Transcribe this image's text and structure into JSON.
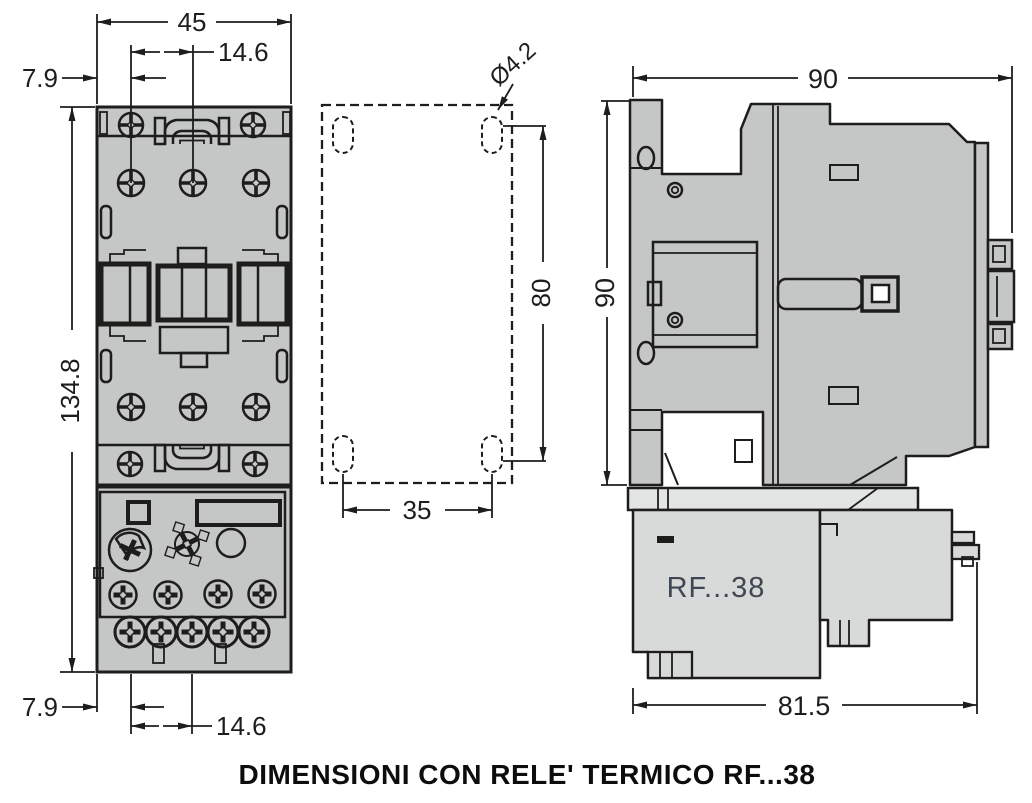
{
  "colors": {
    "line": "#1d1d1b",
    "contactor_fill": "#c5c6c6",
    "relay_fill": "#d8d9d9",
    "relay_strip_fill": "#e3e4e4",
    "relay_label_text": "#3e4752",
    "dim_text": "#1d1d1b",
    "background": "#ffffff"
  },
  "caption": "DIMENSIONI CON RELE' TERMICO RF...38",
  "front_view": {
    "dims": {
      "top_width": "45",
      "top_hole_spacing": "14.6",
      "top_edge_offset": "7.9",
      "total_height": "134.8",
      "bottom_edge_offset": "7.9",
      "bottom_hole_spacing": "14.6"
    }
  },
  "mounting_plan": {
    "dims": {
      "hole_diameter": "Ø4.2",
      "vertical_hole_spacing": "80",
      "horizontal_hole_spacing": "35"
    }
  },
  "side_view": {
    "dims": {
      "width": "90",
      "height": "90",
      "depth_with_relay": "81.5"
    },
    "relay_label": "RF...38"
  }
}
